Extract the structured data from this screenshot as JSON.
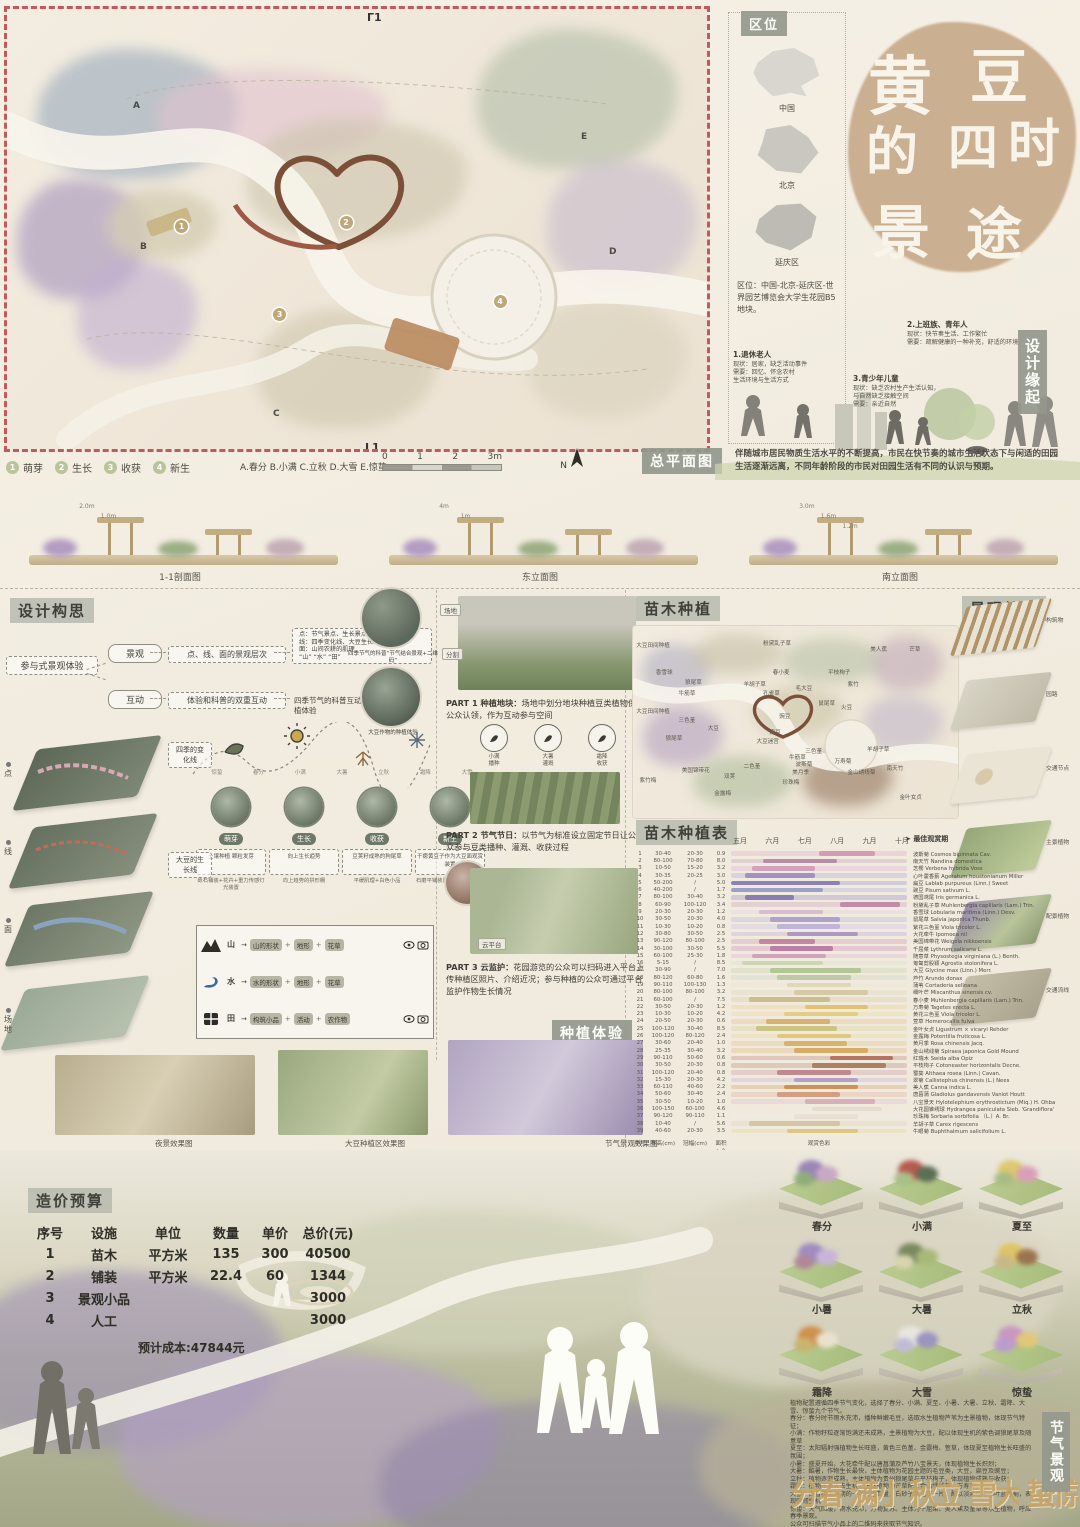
{
  "location": {
    "label": "区位",
    "maps": [
      {
        "name": "中国"
      },
      {
        "name": "北京"
      },
      {
        "name": "延庆区"
      }
    ],
    "text": "区位：中国-北京-延庆区-世界园艺博览会大学生花园B5地块。"
  },
  "title": {
    "chars": [
      "黄",
      "豆",
      "的",
      "四",
      "时",
      "景",
      "途"
    ]
  },
  "origin": {
    "label": "设计缘起",
    "personas": [
      {
        "title": "1.退休老人",
        "lines": [
          "现状：居家，缺乏活动事件",
          "需要：回忆、怀念农村",
          "生活环境与生活方式"
        ]
      },
      {
        "title": "2.上班族、青年人",
        "lines": [
          "现状：快节奏生活、工作繁忙",
          "需要：疏解健康的一种补充，舒适的环境"
        ]
      },
      {
        "title": "3.青少年儿童",
        "lines": [
          "现状：缺乏农村生产生活认知，",
          "与自然缺乏接触空间",
          "需要：亲近自然"
        ]
      }
    ],
    "summary": "伴随城市居民物质生活水平的不断提高，市民在快节奏的城市生活状态下与闲适的田园生活逐渐远离，不同年龄阶段的市民对田园生活有不同的认识与预期。"
  },
  "masterplan": {
    "label": "总平面图",
    "top_mark": "Г1",
    "bottom_mark": "L1",
    "legend": [
      {
        "num": "1",
        "label": "萌芽"
      },
      {
        "num": "2",
        "label": "生长"
      },
      {
        "num": "3",
        "label": "收获"
      },
      {
        "num": "4",
        "label": "新生"
      }
    ],
    "note": "A.春分 B.小满 C.立秋 D.大雪 E.惊蛰",
    "scale_ticks": [
      "0",
      "1",
      "2",
      "3m"
    ],
    "north": "N",
    "markers": [
      {
        "t": "1",
        "x": 24,
        "y": 48
      },
      {
        "t": "2",
        "x": 47.5,
        "y": 47
      },
      {
        "t": "3",
        "x": 38,
        "y": 68
      },
      {
        "t": "4",
        "x": 69.5,
        "y": 65
      }
    ],
    "letters": [
      {
        "t": "A",
        "x": 18,
        "y": 21
      },
      {
        "t": "B",
        "x": 19,
        "y": 53
      },
      {
        "t": "C",
        "x": 38,
        "y": 91
      },
      {
        "t": "D",
        "x": 86,
        "y": 54
      },
      {
        "t": "E",
        "x": 82,
        "y": 28
      }
    ]
  },
  "elevations": [
    {
      "caption": "1-1剖面图",
      "heights": [
        "2.0m",
        "1.0m"
      ]
    },
    {
      "caption": "东立面图",
      "heights": [
        "4m",
        "1m"
      ]
    },
    {
      "caption": "南立面图",
      "heights": [
        "3.0m",
        "1.6m",
        "1.2m"
      ]
    }
  ],
  "concept": {
    "label": "设计构思",
    "root": "参与式景观体验",
    "b1_key": "景观",
    "b1_mid": "点、线、面的景观层次",
    "b1_detail": [
      "点：节气景点、生长景点",
      "线：四季变化线、大豆生长线",
      "面：山间农耕的肌理",
      "“山” “水” “田”"
    ],
    "b2_key": "互动",
    "b2_mid": "体验和科普的双重互动",
    "b2_detail": "四季节气的科普互动、大豆作物的种植体验",
    "circle1_cap": "四季节气的科普“节气结合景观+二维码”",
    "circle2_cap": "大豆作物的种植体验",
    "season_line_label": "四季的变化线",
    "grow_line_label": "大豆的生长线",
    "season_ticks": [
      "惊蛰",
      "春分",
      "小满",
      "大暑",
      "立秋",
      "霜降",
      "大雪"
    ],
    "stages": [
      {
        "name": "萌芽",
        "box": "土壤种植 颗粒发芽",
        "caption": "砾石铺装+花卉+重力传感灯光装置"
      },
      {
        "name": "生长",
        "box": "向上生长趋势",
        "caption": "向上趋势的拱形棚"
      },
      {
        "name": "收获",
        "box": "豆荚籽成熟的狗尾草",
        "caption": "平缓肌理+白色小品"
      },
      {
        "name": "新生",
        "box": "干瘪黄豆子作为大豆面观赏装置",
        "caption": "石磨平铺装置+可视山水景观"
      }
    ],
    "layers": [
      {
        "label": "点"
      },
      {
        "label": "线"
      },
      {
        "label": "面"
      },
      {
        "label": "场地"
      }
    ],
    "mapping": [
      {
        "icon": "mountain",
        "name": "山",
        "steps": [
          "山的形状",
          "地形",
          "花草"
        ],
        "cams": true
      },
      {
        "icon": "water",
        "name": "水",
        "steps": [
          "水的形状",
          "地形",
          "花草"
        ],
        "cams": false
      },
      {
        "icon": "field",
        "name": "田",
        "steps": [
          "构筑小品",
          "活动",
          "农作物"
        ],
        "cams": true
      }
    ]
  },
  "parts": {
    "part1_title": "PART 1 种植地块：",
    "part1_text": "场地中划分地块种植豆类植物供公众认领，作为互动参与空间",
    "part1_tags": [
      "场地",
      "分割"
    ],
    "part2_title": "PART 2 节气节日：",
    "part2_text": "以节气为标准设立固定节日让公众参与豆类播种、灌溉、收获过程",
    "part2_icons": [
      {
        "l1": "小满",
        "l2": "播种"
      },
      {
        "l1": "大暑",
        "l2": "灌溉"
      },
      {
        "l1": "霜降",
        "l2": "收获"
      }
    ],
    "part3_title": "PART 3 云监护：",
    "part3_text": "花园游览的公众可以扫码进入平台上传种植区照片、介绍近况；参与种植的公众可通过平台监护作物生长情况",
    "part3_tag": "云平台",
    "section_label": "种植体验"
  },
  "renders": [
    {
      "t": "夜景效果图",
      "x": 155
    },
    {
      "t": "大豆种植区效果图",
      "x": 345
    },
    {
      "t": "节气景观效果图",
      "x": 605
    }
  ],
  "planting": {
    "label": "苗木种植",
    "map_labels": [
      {
        "t": "大豆田间种植",
        "x": 1,
        "y": 8
      },
      {
        "t": "粉黛乱子草",
        "x": 40,
        "y": 7
      },
      {
        "t": "美人蕉",
        "x": 73,
        "y": 10
      },
      {
        "t": "芒草",
        "x": 85,
        "y": 10
      },
      {
        "t": "香雪球",
        "x": 7,
        "y": 22
      },
      {
        "t": "狼尾草",
        "x": 16,
        "y": 27
      },
      {
        "t": "春小麦",
        "x": 43,
        "y": 22
      },
      {
        "t": "羊胡子草",
        "x": 34,
        "y": 28
      },
      {
        "t": "平枝栒子",
        "x": 60,
        "y": 22
      },
      {
        "t": "孔雀草",
        "x": 40,
        "y": 33
      },
      {
        "t": "紫竹",
        "x": 66,
        "y": 28
      },
      {
        "t": "牛筋草",
        "x": 14,
        "y": 33
      },
      {
        "t": "毛大豆",
        "x": 50,
        "y": 30
      },
      {
        "t": "鼠尾草",
        "x": 57,
        "y": 38
      },
      {
        "t": "火豆",
        "x": 64,
        "y": 40
      },
      {
        "t": "大豆田间种植",
        "x": 1,
        "y": 42
      },
      {
        "t": "三色堇",
        "x": 14,
        "y": 47
      },
      {
        "t": "大豆",
        "x": 23,
        "y": 51
      },
      {
        "t": "狼尾草",
        "x": 10,
        "y": 56
      },
      {
        "t": "豌豆",
        "x": 45,
        "y": 45
      },
      {
        "t": "扁豆",
        "x": 42,
        "y": 53
      },
      {
        "t": "大豆迷宫",
        "x": 38,
        "y": 58
      },
      {
        "t": "万寿菊",
        "x": 62,
        "y": 68
      },
      {
        "t": "金山绣线菊",
        "x": 66,
        "y": 74
      },
      {
        "t": "羊胡子草",
        "x": 72,
        "y": 62
      },
      {
        "t": "三色堇",
        "x": 53,
        "y": 63
      },
      {
        "t": "牛筋草",
        "x": 48,
        "y": 66
      },
      {
        "t": "波斯菊",
        "x": 50,
        "y": 70
      },
      {
        "t": "美月季",
        "x": 49,
        "y": 74
      },
      {
        "t": "珍珠梅",
        "x": 46,
        "y": 79
      },
      {
        "t": "双荚",
        "x": 28,
        "y": 76
      },
      {
        "t": "二色堇",
        "x": 34,
        "y": 71
      },
      {
        "t": "美国锦带花",
        "x": 15,
        "y": 73
      },
      {
        "t": "金露梅",
        "x": 25,
        "y": 85
      },
      {
        "t": "紫竹梅",
        "x": 2,
        "y": 78
      },
      {
        "t": "南天竹",
        "x": 78,
        "y": 72
      },
      {
        "t": "金叶女贞",
        "x": 82,
        "y": 87
      }
    ]
  },
  "structure": {
    "label": "景观结构",
    "layers": [
      {
        "name": "构筑物"
      },
      {
        "name": "园路"
      },
      {
        "name": "交通节点"
      },
      {
        "name": "主景植物"
      },
      {
        "name": "配景植物"
      },
      {
        "name": "交通流线"
      }
    ]
  },
  "plant_table": {
    "label": "苗木种植表",
    "months": [
      "五月",
      "六月",
      "七月",
      "八月",
      "九月",
      "十月"
    ],
    "best_label": "最佳观赏期",
    "footer": {
      "c0": "序号",
      "c1": "株高(cm)",
      "c2": "冠幅(cm)",
      "c3": "面积(㎡)",
      "c4": "观赏色彩"
    },
    "rows": [
      {
        "no": "1",
        "h": "30-40",
        "c": "20-30",
        "a": "0.9",
        "name": "波斯菊 Cosmos bipinnata Cav.",
        "color": "#d49cb4",
        "peak": [
          50,
          32
        ]
      },
      {
        "no": "2",
        "h": "80-100",
        "c": "70-80",
        "a": "8.0",
        "name": "南天竹 Nandina domestica",
        "color": "#b48ea6",
        "peak": [
          18,
          42
        ]
      },
      {
        "no": "3",
        "h": "10-50",
        "c": "15-20",
        "a": "3.2",
        "name": "芝樱 Verbena hybrida Voss",
        "color": "#d2a0c0",
        "peak": [
          12,
          36
        ]
      },
      {
        "no": "4",
        "h": "30-35",
        "c": "20-25",
        "a": "3.0",
        "name": "心叶藿香蓟 Ageratum houstonianum Miller",
        "color": "#a292c2",
        "peak": [
          8,
          40
        ]
      },
      {
        "no": "5",
        "h": "50-200",
        "c": "/",
        "a": "5.0",
        "name": "扁豆 Lablab purpureus (Linn.) Sweet",
        "color": "#8c82b4",
        "peak": [
          0,
          62
        ]
      },
      {
        "no": "6",
        "h": "40-200",
        "c": "/",
        "a": "1.7",
        "name": "豌豆 Pisum sativum L.",
        "color": "#9aa0c8",
        "peak": [
          0,
          52
        ]
      },
      {
        "no": "7",
        "h": "80-100",
        "c": "30-40",
        "a": "3.2",
        "name": "德国鸢尾 Iris germanica L.",
        "color": "#887eb2",
        "peak": [
          8,
          28
        ]
      },
      {
        "no": "8",
        "h": "60-90",
        "c": "100-120",
        "a": "3.4",
        "name": "粉黛乱子草 Muhlenbergia capillaris (Lam.) Trin.",
        "color": "#c08ca8",
        "peak": [
          62,
          34
        ]
      },
      {
        "no": "9",
        "h": "20-30",
        "c": "20-30",
        "a": "1.2",
        "name": "香雪球 Lobularia maritima (Linn.) Desv.",
        "color": "#d8bcd0",
        "peak": [
          16,
          36
        ]
      },
      {
        "no": "10",
        "h": "30-50",
        "c": "20-30",
        "a": "4.0",
        "name": "鼠尾草 Salvia japonica Thunb.",
        "color": "#aca2cc",
        "peak": [
          22,
          40
        ]
      },
      {
        "no": "11",
        "h": "10-30",
        "c": "10-20",
        "a": "0.8",
        "name": "紫花三色堇 Viola tricolor L.",
        "color": "#c2b4d8",
        "peak": [
          26,
          36
        ]
      },
      {
        "no": "12",
        "h": "30-80",
        "c": "30-50",
        "a": "2.5",
        "name": "大花牵牛 Ipomoea nil",
        "color": "#ac98c4",
        "peak": [
          32,
          40
        ]
      },
      {
        "no": "13",
        "h": "90-120",
        "c": "80-100",
        "a": "2.5",
        "name": "美国锦带花 Weigela nikkoensis",
        "color": "#c486a0",
        "peak": [
          16,
          32
        ]
      },
      {
        "no": "14",
        "h": "30-100",
        "c": "30-50",
        "a": "5.5",
        "name": "千屈菜 Lythrum salicaria L.",
        "color": "#bc7ea4",
        "peak": [
          22,
          36
        ]
      },
      {
        "no": "15",
        "h": "60-100",
        "c": "25-30",
        "a": "1.8",
        "name": "随意草 Physostegia virginiana (L.) Benth.",
        "color": "#d0a2bc",
        "peak": [
          12,
          42
        ]
      },
      {
        "no": "16",
        "h": "5-15",
        "c": "/",
        "a": "8.5",
        "name": "匍匐剪股颖 Agrostis stolonifera L.",
        "color": "#ccd6b4",
        "peak": [
          6,
          46
        ]
      },
      {
        "no": "17",
        "h": "30-90",
        "c": "/",
        "a": "7.0",
        "name": "大豆 Glycine max (Linn.) Merr.",
        "color": "#b4c694",
        "peak": [
          22,
          52
        ]
      },
      {
        "no": "18",
        "h": "80-120",
        "c": "60-80",
        "a": "1.6",
        "name": "芦竹 Arundo donax",
        "color": "#bec9aa",
        "peak": [
          26,
          42
        ]
      },
      {
        "no": "19",
        "h": "90-110",
        "c": "100-130",
        "a": "1.3",
        "name": "蒲苇 Cortaderia selloana",
        "color": "#ded8ba",
        "peak": [
          32,
          36
        ]
      },
      {
        "no": "20",
        "h": "80-100",
        "c": "80-100",
        "a": "3.2",
        "name": "细叶芒 Miscanthus sinensis cv.",
        "color": "#d6caa6",
        "peak": [
          36,
          42
        ]
      },
      {
        "no": "21",
        "h": "60-100",
        "c": "/",
        "a": "7.5",
        "name": "春小麦 Muhlenbergia capillaris (Lam.) Trin.",
        "color": "#ccbe8c",
        "peak": [
          10,
          46
        ]
      },
      {
        "no": "22",
        "h": "30-50",
        "c": "20-30",
        "a": "1.2",
        "name": "万寿菊 Tagetes erecta L.",
        "color": "#dec276",
        "peak": [
          42,
          36
        ]
      },
      {
        "no": "23",
        "h": "10-30",
        "c": "10-20",
        "a": "4.2",
        "name": "黄花三色堇 Viola tricolor L.",
        "color": "#e2cc86",
        "peak": [
          30,
          42
        ]
      },
      {
        "no": "24",
        "h": "20-50",
        "c": "20-30",
        "a": "0.6",
        "name": "萱草 Hemerocallis fulva",
        "color": "#d8b072",
        "peak": [
          20,
          36
        ]
      },
      {
        "no": "25",
        "h": "100-120",
        "c": "30-40",
        "a": "8.5",
        "name": "金叶女贞 Ligustrum × vicaryi Rehder",
        "color": "#ccc482",
        "peak": [
          14,
          46
        ]
      },
      {
        "no": "26",
        "h": "100-120",
        "c": "80-120",
        "a": "2.4",
        "name": "金露梅 Potentilla fruticosa L.",
        "color": "#dfc87e",
        "peak": [
          26,
          42
        ]
      },
      {
        "no": "27",
        "h": "30-60",
        "c": "20-40",
        "a": "1.0",
        "name": "黄月季 Rosa chinensis Jacq.",
        "color": "#d6b470",
        "peak": [
          30,
          36
        ]
      },
      {
        "no": "28",
        "h": "25-35",
        "c": "30-40",
        "a": "3.2",
        "name": "金山绣线菊 Spiraea japonica Gold Mound",
        "color": "#d4ac62",
        "peak": [
          36,
          42
        ]
      },
      {
        "no": "29",
        "h": "90-110",
        "c": "50-60",
        "a": "0.6",
        "name": "红瑞木 Swida alba Opiz",
        "color": "#b47464",
        "peak": [
          56,
          36
        ]
      },
      {
        "no": "30",
        "h": "30-50",
        "c": "20-30",
        "a": "0.8",
        "name": "平枝栒子 Cotoneaster horizontalis Decne.",
        "color": "#ac8062",
        "peak": [
          46,
          42
        ]
      },
      {
        "no": "31",
        "h": "100-120",
        "c": "20-40",
        "a": "0.8",
        "name": "蜀葵 Althaea rosea (Linn.) Cavan.",
        "color": "#c08890",
        "peak": [
          26,
          42
        ]
      },
      {
        "no": "32",
        "h": "15-30",
        "c": "20-30",
        "a": "4.2",
        "name": "翠菊 Callistephus chinensis (L.) Nees",
        "color": "#b4a0c6",
        "peak": [
          36,
          36
        ]
      },
      {
        "no": "33",
        "h": "60-110",
        "c": "40-60",
        "a": "2.2",
        "name": "美人蕉 Canna indica L.",
        "color": "#cc9058",
        "peak": [
          30,
          42
        ]
      },
      {
        "no": "34",
        "h": "50-60",
        "c": "30-40",
        "a": "2.4",
        "name": "唐菖蒲 Gladiolus gandavensis Vaniot Houtt",
        "color": "#d49e82",
        "peak": [
          26,
          36
        ]
      },
      {
        "no": "35",
        "h": "30-50",
        "c": "10-20",
        "a": "1.0",
        "name": "八宝景天 Hylotelephium erythrostictum (Miq.) H. Ohba",
        "color": "#d6b0bc",
        "peak": [
          42,
          40
        ]
      },
      {
        "no": "36",
        "h": "100-150",
        "c": "60-100",
        "a": "4.6",
        "name": "大花圆锥绣球 Hydrangea paniculata Sieb. 'Grandiflora'",
        "color": "#e4dcce",
        "peak": [
          46,
          40
        ]
      },
      {
        "no": "37",
        "h": "90-120",
        "c": "90-110",
        "a": "1.1",
        "name": "珍珠梅 Sorbaria sorbifolia （L.）A. Br.",
        "color": "#e8e0d2",
        "peak": [
          36,
          36
        ]
      },
      {
        "no": "38",
        "h": "10-40",
        "c": "/",
        "a": "5.6",
        "name": "羊胡子草 Carex rigescens",
        "color": "#d4c6a4",
        "peak": [
          10,
          52
        ]
      },
      {
        "no": "39",
        "h": "40-60",
        "c": "20-30",
        "a": "3.5",
        "name": "牛眼菊 Buphthalmum salicifolium L.",
        "color": "#dcc883",
        "peak": [
          32,
          40
        ]
      }
    ]
  },
  "budget": {
    "label": "造价预算",
    "headers": [
      "序号",
      "设施",
      "单位",
      "数量",
      "单价",
      "总价(元)"
    ],
    "rows": [
      {
        "c0": "1",
        "c1": "苗木",
        "c2": "平方米",
        "c3": "135",
        "c4": "300",
        "c5": "40500"
      },
      {
        "c0": "2",
        "c1": "铺装",
        "c2": "平方米",
        "c3": "22.4",
        "c4": "60",
        "c5": "1344"
      },
      {
        "c0": "3",
        "c1": "景观小品",
        "c2": "",
        "c3": "",
        "c4": "",
        "c5": "3000"
      },
      {
        "c0": "4",
        "c1": "人工",
        "c2": "",
        "c3": "",
        "c4": "",
        "c5": "3000"
      }
    ],
    "total": "预计成本:47844元"
  },
  "seasons": {
    "label": "节气景观",
    "tiles": [
      {
        "name": "春分",
        "colors": [
          "#9b86b8",
          "#c9a8c6",
          "#8fae78"
        ]
      },
      {
        "name": "小满",
        "colors": [
          "#b85a50",
          "#5c6e54",
          "#a8c08a"
        ]
      },
      {
        "name": "夏至",
        "colors": [
          "#e0c870",
          "#d8a0b8",
          "#a8bc84"
        ]
      },
      {
        "name": "小暑",
        "colors": [
          "#a08cc0",
          "#c8b4d8",
          "#b08898"
        ]
      },
      {
        "name": "大暑",
        "colors": [
          "#7a8a5e",
          "#a8b878",
          "#d8d4b0"
        ]
      },
      {
        "name": "立秋",
        "colors": [
          "#e0c468",
          "#9a7450",
          "#c8b888"
        ]
      },
      {
        "name": "霜降",
        "colors": [
          "#d09050",
          "#e8e2cc",
          "#c8b470"
        ]
      },
      {
        "name": "大雪",
        "colors": [
          "#e8e6e0",
          "#9a94c0",
          "#c0bcd8"
        ]
      },
      {
        "name": "惊蛰",
        "colors": [
          "#c898c0",
          "#e0c878",
          "#ba9cd0"
        ]
      }
    ],
    "text_lines": [
      "植物配置遵循四季节气变化，选择了春分、小满、夏至、小暑、大暑、立秋、霜降、大雪、惊蛰九个节气。",
      "春分：春分时节雨水充沛，播种鲜嫩毛豆，选取水生植物芦苇为主景植物，体现节气特征；",
      "小满：作物籽粒逐渐饱满还未成熟，主景植物为大豆，配以体现生机的紫色调狼尾草及随意草",
      "夏至：太阳辐射强植物生长旺盛，黄色三色堇、金露梅、萱草，体现夏至植物生长旺盛的氛围；",
      "小暑：盛夏开始，大花牵牛配以唐菖蒲及芦竹八宝景天，体现植物生长炽烈；",
      "大暑：酷暑，作物生长最快，主体植物为花园主题的毛豆类，大豆，扁豆及豌豆；",
      "立秋：植物逐渐成熟，主体植物为贵州狼尾草与平枝栒子，体现植物成熟与收获；",
      "霜降：植物逐渐失去生机，主体植物为芒草配以金山绣线菊、万寿菊；",
      "大雪：白雪覆盖为期的一年彩色数量，白砂子草花压一片，配以淡紫色与心叶蓝香蓟，表现强韧生机",
      "惊蛰：天气回暖，雨水充沛，万物复苏。主体为千屈菜、美人蕉及堇草等水生植物，呼应春季景观。",
      "公众可扫描节气小品上的二维码来获取节气知识。"
    ],
    "stamps": [
      {
        "t": "春分"
      },
      {
        "t": "小满"
      },
      {
        "t": "立秋"
      },
      {
        "t": "大雪"
      },
      {
        "t": "惊蛰"
      }
    ]
  }
}
